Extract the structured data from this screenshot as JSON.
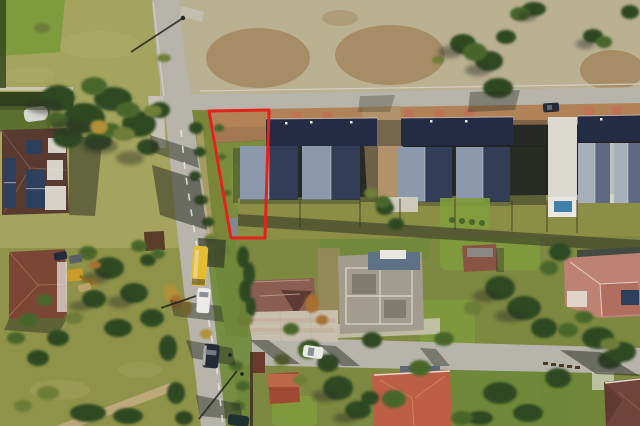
{
  "scene": {
    "type": "aerial-drone-photograph",
    "description": "Bird's-eye view of a suburban street in autumn: a narrow vacant plot outlined in red sits between a road and a row of new grey-roofed terraced houses; detached houses with maroon and salmon roofs, a construction site with foundations, fields, conifers and vehicles (yellow bus, white van, cars) are visible.",
    "overlay": {
      "label": "property-boundary",
      "color": "#e3231b",
      "shape": "narrow trapezoid plot outline, widest at the street, with a small dark shed at its lower end"
    },
    "landmarks": [
      "vertical-street-with-lane-markings",
      "top-cross-street",
      "bottom-cross-street",
      "red-outlined-vacant-parcel",
      "terraced-house-row-grey-roofs",
      "house-with-solar-panels",
      "maroon-roof-house",
      "construction-site-foundations",
      "salmon-roof-house",
      "large-pink-roof-house",
      "yellow-bus",
      "white-van",
      "dark-car",
      "excavator",
      "conifer-cluster",
      "autumn-fields",
      "backyard-pool"
    ]
  },
  "palette": {
    "road": "#b7b4ac",
    "road_shoulder": "#c6c2b6",
    "curb": "#d8d4c8",
    "lane": "#e9e7df",
    "dirt_strip": "#b28257",
    "paver_red": "#c07254",
    "paver_pale": "#c9bfae",
    "paver_pink": "#c2a18c",
    "paver_line": "#b5ab9a",
    "gap_dirt": "#b2926a",
    "path_tan": "#c2ab80",
    "dirt_open": "#a08a64",
    "field_tl": "#a4a45e",
    "field_tl_light": "#b2b06e",
    "corner_green": "#7e9c3e",
    "field_tr": "#bab092",
    "dirt_patch": "#a3855c",
    "field_bl": "#8f9349",
    "field_bl_light": "#a8a86a",
    "field_br": "#7d8840",
    "lawn": "#6f8838",
    "lawn_bright": "#7f9c3c",
    "backyard": "#8a8f45",
    "verge": "#7a8638",
    "garden": "#5c7030",
    "parcel_grass": "#7c8c3e",
    "roof_light": "#8c98ac",
    "roof_dark": "#323e58",
    "roof_garage": "#232c44",
    "roof_pale": "#a6aeba",
    "roof_pale_dark": "#5e6a82",
    "ridge_white": "#e6e4dc",
    "white": "#e9e7e0",
    "white_path": "#dcd9d0",
    "concrete": "#a29c8e",
    "concrete_light": "#cfc9bb",
    "wall_line": "#ddd8ca",
    "blue_structure": "#5d7287",
    "pool_blue": "#3f7fa8",
    "shed_dark": "#43484f",
    "shed_light": "#82888f",
    "tree_dark": "#2d4a23",
    "tree_green": "#49662b",
    "tree_olive": "#6e7d37",
    "tree_autumn": "#b09038",
    "tree_orange": "#a96f33",
    "hedge": "#31421f",
    "shadow": "#2d3125",
    "shadow_line": "#23261c",
    "h1_roof": "#583a31",
    "h1_ridge": "#8a6a58",
    "solar_panel": "#2e3f5e",
    "h2_roof": "#7c4636",
    "h2_ridge": "#a5705a",
    "brown_house": "#5a3c28",
    "h3_roof": "#8a5e50",
    "h3_dark": "#5e3c34",
    "h3_ridge": "#c2a092",
    "red_shed": "#a04a34",
    "red_shed_light": "#c06a4a",
    "red_gate": "#6b3a2c",
    "h4_roof": "#bc5f45",
    "h4_ridge": "#d08a6a",
    "h4_gray": "#5a6878",
    "h5_roof": "#8a5444",
    "h5_ridge": "#8b8d8a",
    "h6_roof": "#bd8273",
    "h6_shade": "#a56052",
    "h6_dark": "#434a42",
    "h6_ridge": "#e8d8d0",
    "h7_roof": "#6e4538",
    "h7_shade": "#54332a",
    "h7_ridge": "#9a6a54",
    "greenhouse": "#d8d8d2",
    "fence": "#4a3a26",
    "fence_pale": "#cfcabc",
    "bus_yellow": "#e5bd2e",
    "vehicle_white": "#eceae6",
    "vehicle_dark": "#242b36",
    "vehicle_gray": "#5a6068",
    "vehicle_teal": "#1e3330",
    "glass": "#8a8f96",
    "excavator_yellow": "#c99b2d",
    "excavator_arm": "#8a6a1e",
    "trailer": "#b8a26a",
    "person": "#1d2024",
    "outline_red": "#e3231b"
  }
}
